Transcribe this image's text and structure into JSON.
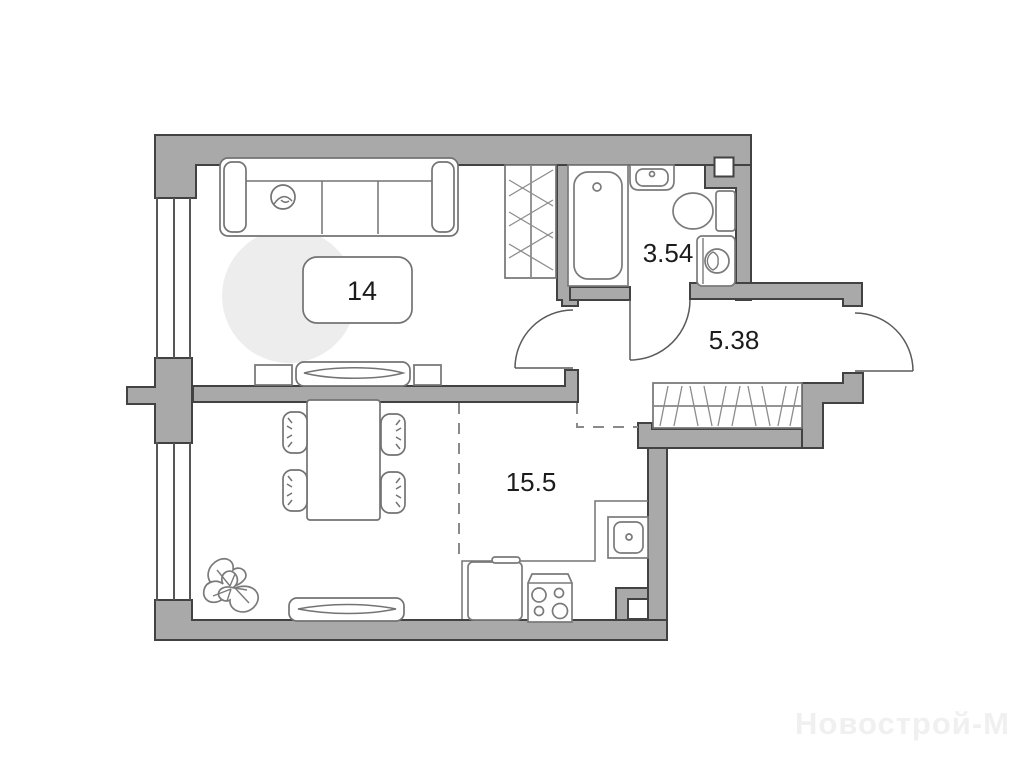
{
  "plan": {
    "rooms": [
      {
        "id": "living-room",
        "area": "14"
      },
      {
        "id": "bathroom",
        "area": "3.54"
      },
      {
        "id": "hallway",
        "area": "5.38"
      },
      {
        "id": "kitchen-dining",
        "area": "15.5"
      }
    ],
    "watermark": "Новострой-М",
    "colors": {
      "wall_fill": "#a9a9a9",
      "wall_stroke": "#424242",
      "furniture_stroke": "#737373",
      "rug_fill": "#ededed",
      "dash_color": "#8a8a8a",
      "door_arc": "#5a5a5a",
      "label_color": "#1c1c1c",
      "watermark_color": "#f0f0f0",
      "background": "#ffffff"
    }
  }
}
